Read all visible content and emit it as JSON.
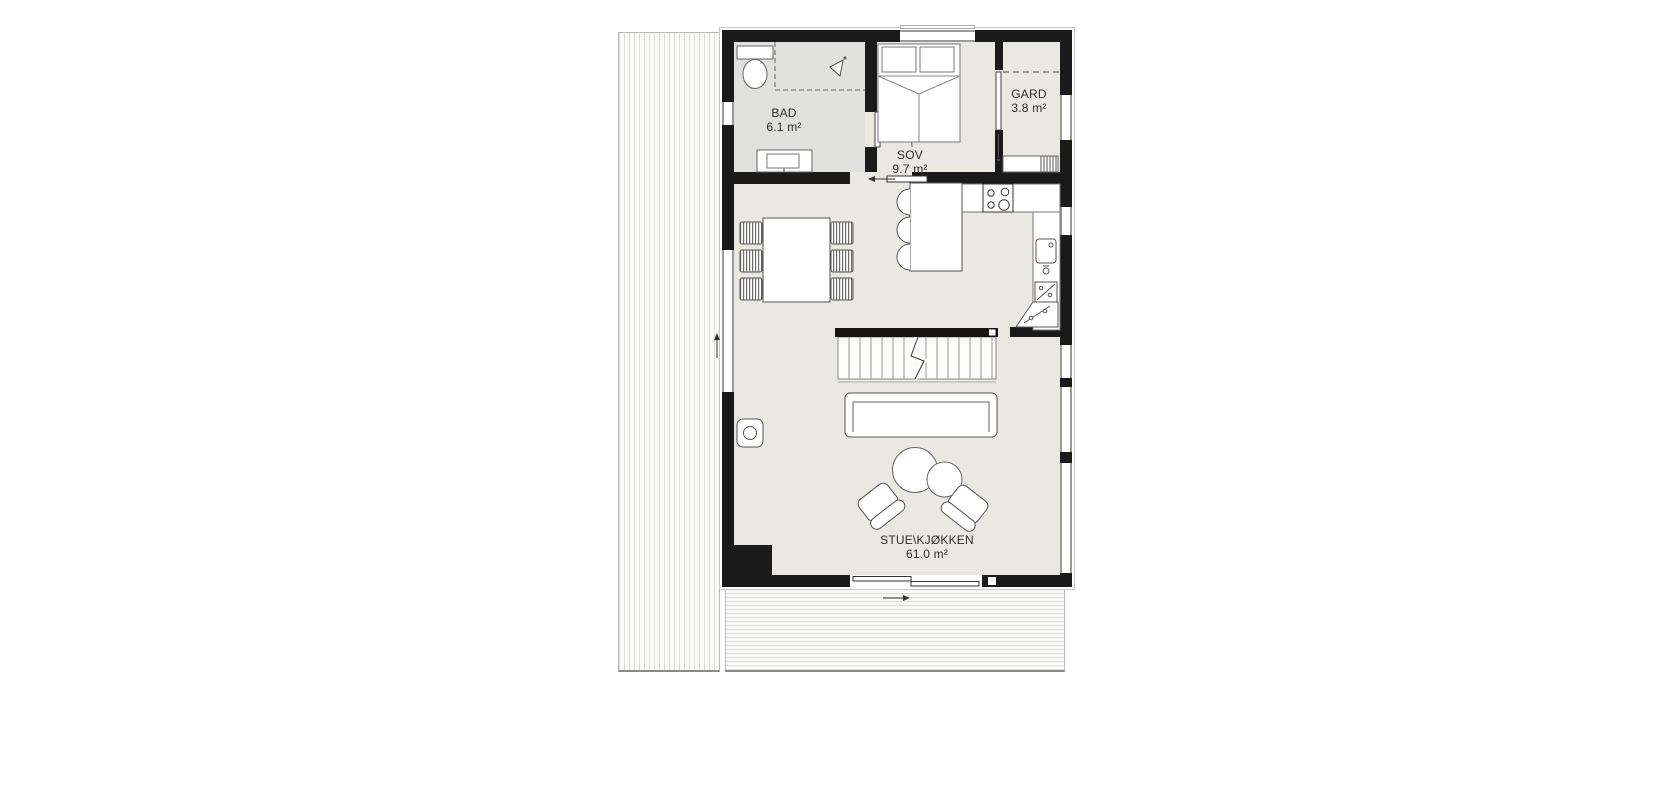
{
  "plan": {
    "rooms": [
      {
        "id": "bad",
        "name": "BAD",
        "area": "6.1 m²"
      },
      {
        "id": "sov",
        "name": "SOV",
        "area": "9.7 m²"
      },
      {
        "id": "gard",
        "name": "GARD",
        "area": "3.8 m²"
      },
      {
        "id": "stue_kjokken",
        "name": "STUE\\KJØKKEN",
        "area": "61.0 m²"
      }
    ],
    "colors": {
      "wall": "#1a1a1a",
      "floor": "#e9e8e2",
      "bath_floor": "#e0e0df",
      "furniture_line": "#666666",
      "deck_line": "#dcdcdc",
      "background": "#ffffff"
    },
    "symbols": [
      "toilet-icon",
      "shower-icon",
      "vanity-sink-icon",
      "double-bed-icon",
      "wardrobe-icon",
      "hinged-door-icon",
      "sliding-door-icon",
      "cooktop-icon",
      "kitchen-sink-icon",
      "dishwasher-icon",
      "corner-cabinet-icon",
      "kitchen-island-icon",
      "bar-stool-icon",
      "dining-table-icon",
      "dining-chair-icon",
      "staircase-icon",
      "sofa-icon",
      "coffee-table-icon",
      "armchair-icon",
      "wood-stove-icon",
      "deck-boards"
    ]
  }
}
